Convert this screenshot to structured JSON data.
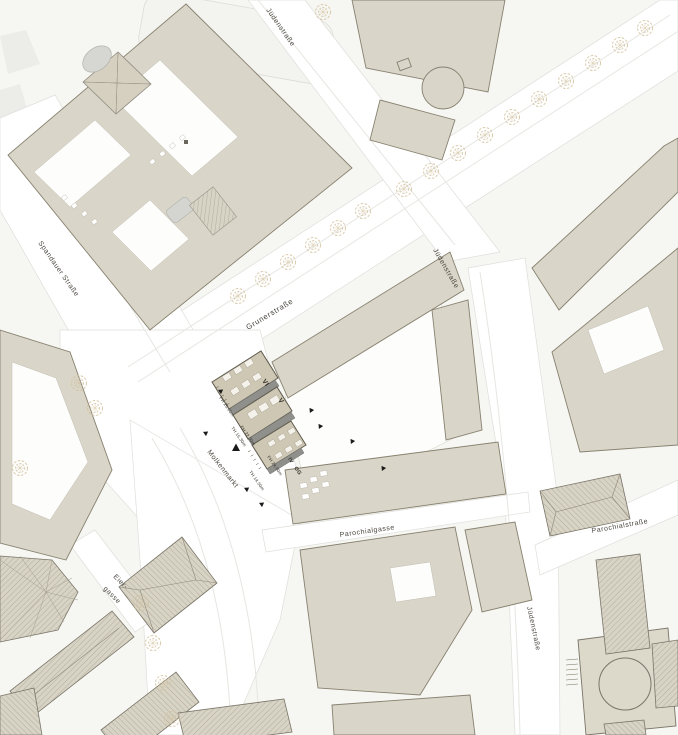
{
  "streets": {
    "juedenstrasse_north": "Jüdenstraße",
    "juedenstrasse_mid": "Jüdenstraße",
    "juedenstrasse_south": "Jüdenstraße",
    "spandauer_strasse": "Spandauer Straße",
    "grunerstrasse": "Grunerstraße",
    "molkenmarkt": "Molkenmarkt",
    "parochialgasse": "Parochialgasse",
    "parochialstrasse": "Parochialstraße",
    "eiergasse_line1": "Eier-",
    "eiergasse_line2": "gasse"
  },
  "site_annotations": {
    "storeys": {
      "strip_a": "VI",
      "strip_b": "V",
      "corner_a": "IV",
      "corner_b": "OG"
    },
    "heights": {
      "ridge_a": "FH 25.60m",
      "ridge_b": "FH 22.30m",
      "ridge_c": "FH 24.60m",
      "eaves_a": "TH 15.30m",
      "eaves_b": "TH 14.50m"
    }
  },
  "icons": {
    "tree": "tree-icon",
    "entrance_marker": "entrance-arrow-icon",
    "elevation_marker": "elevation-marker-icon"
  },
  "colors": {
    "background": "#f6f6f3",
    "street": "#ffffff",
    "block_fill": "#d9d5c8",
    "block_outline": "#87816f",
    "new_building_fill": "#cdc7b4",
    "new_building_outline": "#5f5a4c",
    "passage_gray": "#8f8f8c",
    "roof_hatch": "#aaa496",
    "tree": "#d0bd96",
    "label_text": "#3e3a31"
  }
}
